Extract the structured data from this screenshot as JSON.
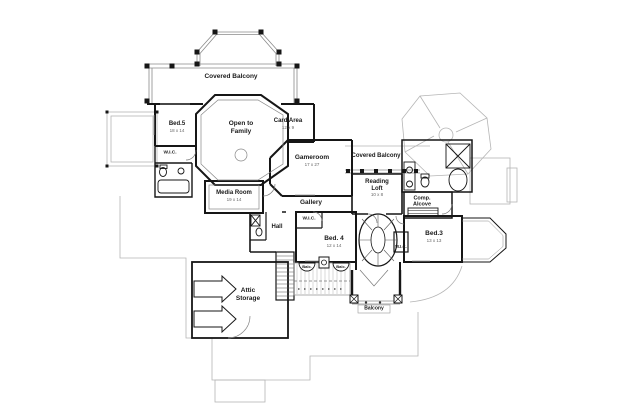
{
  "style": {
    "background": "#ffffff",
    "ink": "#1a1a1a",
    "light_line": "#aaaaaa"
  },
  "rooms": {
    "covered_balcony_top": {
      "label": "Covered Balcony"
    },
    "bed5": {
      "label": "Bed.5",
      "dims": "18 x 14"
    },
    "open_to_family": {
      "line1": "Open to",
      "line2": "Family"
    },
    "card_area": {
      "label": "Card Area",
      "dims": "12 x 9"
    },
    "gameroom": {
      "label": "Gameroom",
      "dims": "17 x 27"
    },
    "covered_balcony_right": {
      "label": "Covered Balcony"
    },
    "reading_loft": {
      "line1": "Reading",
      "line2": "Loft",
      "dims": "10 x 8"
    },
    "comp_alcove": {
      "line1": "Comp.",
      "line2": "Alcove"
    },
    "wic_left": {
      "label": "W.I.C."
    },
    "media_room": {
      "label": "Media Room",
      "dims": "19 x 14"
    },
    "gallery": {
      "label": "Gallery"
    },
    "hall": {
      "label": "Hall"
    },
    "wic_bed4": {
      "label": "W.I.C."
    },
    "bed4": {
      "label": "Bed. 4",
      "dims": "12 x 14"
    },
    "wic_bed3": {
      "label": "W.I.C."
    },
    "bed3": {
      "label": "Bed.3",
      "dims": "13 x 13"
    },
    "attic_storage": {
      "line1": "Attic",
      "line2": "Storage"
    },
    "balcony_bottom": {
      "label": "Balcony"
    },
    "balc_small_left": {
      "label": "Balc."
    },
    "balc_small_right": {
      "label": "Balc."
    }
  }
}
